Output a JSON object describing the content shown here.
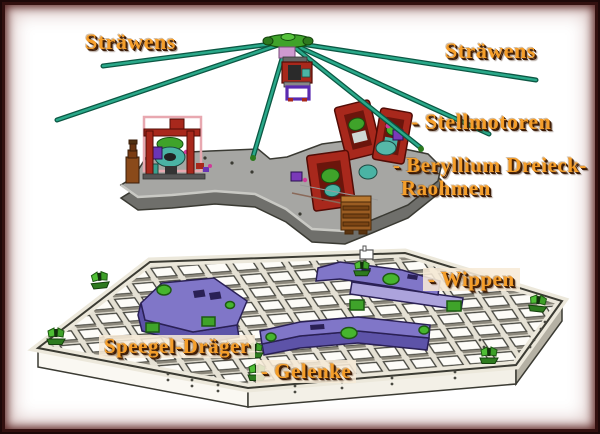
{
  "labels": {
    "strawens_left": "Sträwens",
    "strawens_right": "Sträwens",
    "stellmotoren": "- Stellmotoren",
    "beryllium_line1": "- Beryllium Dreieck-",
    "beryllium_line2": "Raohmen",
    "wippen": "- Wippen",
    "speegel_draeger": "Speegel-Dräger",
    "gelenke": "- Gelenke"
  },
  "colors": {
    "label_text": "#F59E2A",
    "label_shadow": "#3A1A06",
    "label_box": "#F7EBD7",
    "frame_border": "#2A0D0D",
    "background": "#FFFFFF",
    "strut_green": "#1F9E7E",
    "hub_green": "#3FA32A",
    "plate_gray": "#A6A6A3",
    "motor_red": "#A8281C",
    "actuator_brown": "#9A5C22",
    "mirror_surface": "#EFECE3",
    "wippe_purple": "#8076C8",
    "gelenk_green": "#46B52E"
  }
}
